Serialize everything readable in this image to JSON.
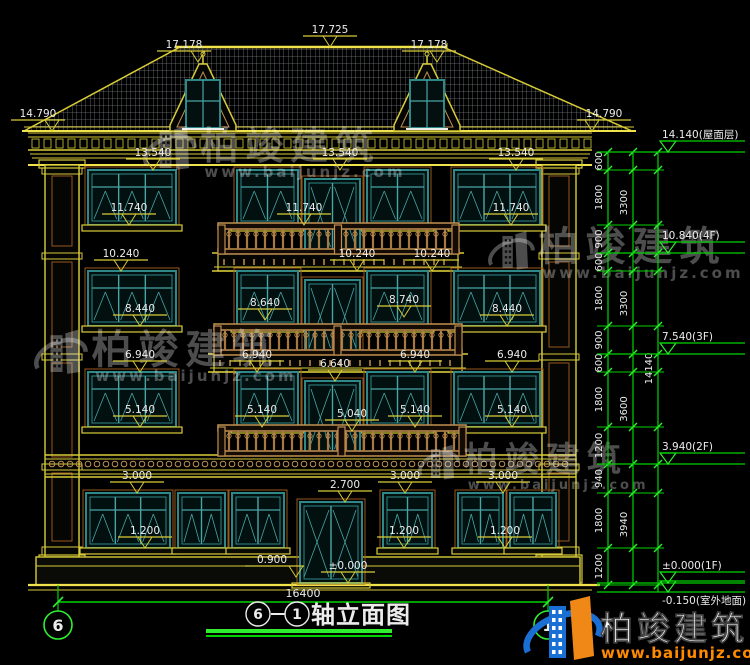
{
  "page": {
    "bg": "#000000"
  },
  "brand": {
    "name": "柏竣建筑",
    "url": "www.baijunjz.com"
  },
  "title": {
    "axis_left": "6",
    "separator": "—",
    "axis_right": "1",
    "text": "轴立面图"
  },
  "bottom_width_dim": "16400",
  "roof": {
    "ridge_label": "17.725",
    "dormer_labels": [
      "17.178",
      "17.178"
    ],
    "eave_labels": [
      "14.790",
      "14.790"
    ]
  },
  "elevation_labels": [
    {
      "t": "17.725",
      "x": 330,
      "y": 47
    },
    {
      "t": "17.178",
      "x": 184,
      "y": 62,
      "tx": 198
    },
    {
      "t": "17.178",
      "x": 429,
      "y": 62,
      "tx": 437
    },
    {
      "t": "14.790",
      "x": 38,
      "y": 131,
      "tx": 52
    },
    {
      "t": "14.790",
      "x": 604,
      "y": 131,
      "tx": 592
    },
    {
      "t": "13.540",
      "x": 153,
      "y": 170
    },
    {
      "t": "13.540",
      "x": 340,
      "y": 170
    },
    {
      "t": "13.540",
      "x": 516,
      "y": 170
    },
    {
      "t": "11.740",
      "x": 129,
      "y": 225
    },
    {
      "t": "11.740",
      "x": 304,
      "y": 225
    },
    {
      "t": "11.740",
      "x": 511,
      "y": 225
    },
    {
      "t": "10.240",
      "x": 121,
      "y": 271
    },
    {
      "t": "10.240",
      "x": 357,
      "y": 271
    },
    {
      "t": "10.240",
      "x": 432,
      "y": 271
    },
    {
      "t": "8.440",
      "x": 140,
      "y": 326
    },
    {
      "t": "8.640",
      "x": 265,
      "y": 320
    },
    {
      "t": "8.740",
      "x": 404,
      "y": 317
    },
    {
      "t": "8.440",
      "x": 507,
      "y": 326
    },
    {
      "t": "6.940",
      "x": 140,
      "y": 372
    },
    {
      "t": "6.940",
      "x": 257,
      "y": 372
    },
    {
      "t": "6.940",
      "x": 415,
      "y": 372
    },
    {
      "t": "6.940",
      "x": 512,
      "y": 372
    },
    {
      "t": "6.640",
      "x": 335,
      "y": 381
    },
    {
      "t": "5.140",
      "x": 140,
      "y": 427
    },
    {
      "t": "5.140",
      "x": 262,
      "y": 427
    },
    {
      "t": "5.040",
      "x": 352,
      "y": 431
    },
    {
      "t": "5.140",
      "x": 415,
      "y": 427
    },
    {
      "t": "5.140",
      "x": 512,
      "y": 427
    },
    {
      "t": "3.000",
      "x": 137,
      "y": 493
    },
    {
      "t": "3.000",
      "x": 405,
      "y": 493
    },
    {
      "t": "3.000",
      "x": 503,
      "y": 493
    },
    {
      "t": "2.700",
      "x": 345,
      "y": 502
    },
    {
      "t": "1.200",
      "x": 145,
      "y": 548
    },
    {
      "t": "1.200",
      "x": 404,
      "y": 548
    },
    {
      "t": "1.200",
      "x": 505,
      "y": 548
    },
    {
      "t": "0.900",
      "x": 272,
      "y": 577,
      "tx": 296
    },
    {
      "t": "±0.000",
      "x": 348,
      "y": 583
    }
  ],
  "right_chain": {
    "inner": [
      {
        "t": "600",
        "a": 152,
        "b": 170
      },
      {
        "t": "1800",
        "a": 170,
        "b": 225
      },
      {
        "t": "900",
        "a": 225,
        "b": 253
      },
      {
        "t": "600",
        "a": 253,
        "b": 271
      },
      {
        "t": "1800",
        "a": 271,
        "b": 326
      },
      {
        "t": "900",
        "a": 326,
        "b": 354
      },
      {
        "t": "600",
        "a": 354,
        "b": 372
      },
      {
        "t": "1800",
        "a": 372,
        "b": 427
      },
      {
        "t": "1200",
        "a": 427,
        "b": 464
      },
      {
        "t": "940",
        "a": 464,
        "b": 493
      },
      {
        "t": "1800",
        "a": 493,
        "b": 548
      },
      {
        "t": "1200",
        "a": 548,
        "b": 585
      }
    ],
    "floor": [
      {
        "t": "3300",
        "a": 152,
        "b": 253
      },
      {
        "t": "3300",
        "a": 253,
        "b": 354
      },
      {
        "t": "3600",
        "a": 354,
        "b": 464
      },
      {
        "t": "3940",
        "a": 464,
        "b": 585
      }
    ],
    "total": {
      "t": "14140",
      "a": 152,
      "b": 585
    },
    "levels": [
      {
        "t": "14.140(屋面层)",
        "y": 152,
        "below": false
      },
      {
        "t": "10.840(4F)",
        "y": 253,
        "below": false
      },
      {
        "t": "7.540(3F)",
        "y": 354,
        "below": false
      },
      {
        "t": "3.940(2F)",
        "y": 464,
        "below": false
      },
      {
        "t": "±0.000(1F)",
        "y": 583,
        "below": false
      },
      {
        "t": "-0.150(室外地面)",
        "y": 592,
        "below": true
      }
    ]
  },
  "axis_bubbles": [
    {
      "label": "6"
    },
    {
      "label": "1"
    }
  ],
  "colors": {
    "bg": "#000000",
    "cad_yellow": "#d8cc38",
    "cad_yellow_bright": "#efe24a",
    "cad_green": "#00d400",
    "cad_green_bright": "#30ee30",
    "cad_white": "#ececec",
    "teal": "#2e8888",
    "teal_light": "#49a5a5",
    "tan": "#c09050",
    "brown": "#96581e",
    "dark_fill": "#050503",
    "watermark": "rgba(255,255,255,0.30)",
    "logo_blue": "#1a6fd4",
    "logo_orange": "#f08818",
    "mesh": "rgba(215,222,228,0.52)"
  }
}
